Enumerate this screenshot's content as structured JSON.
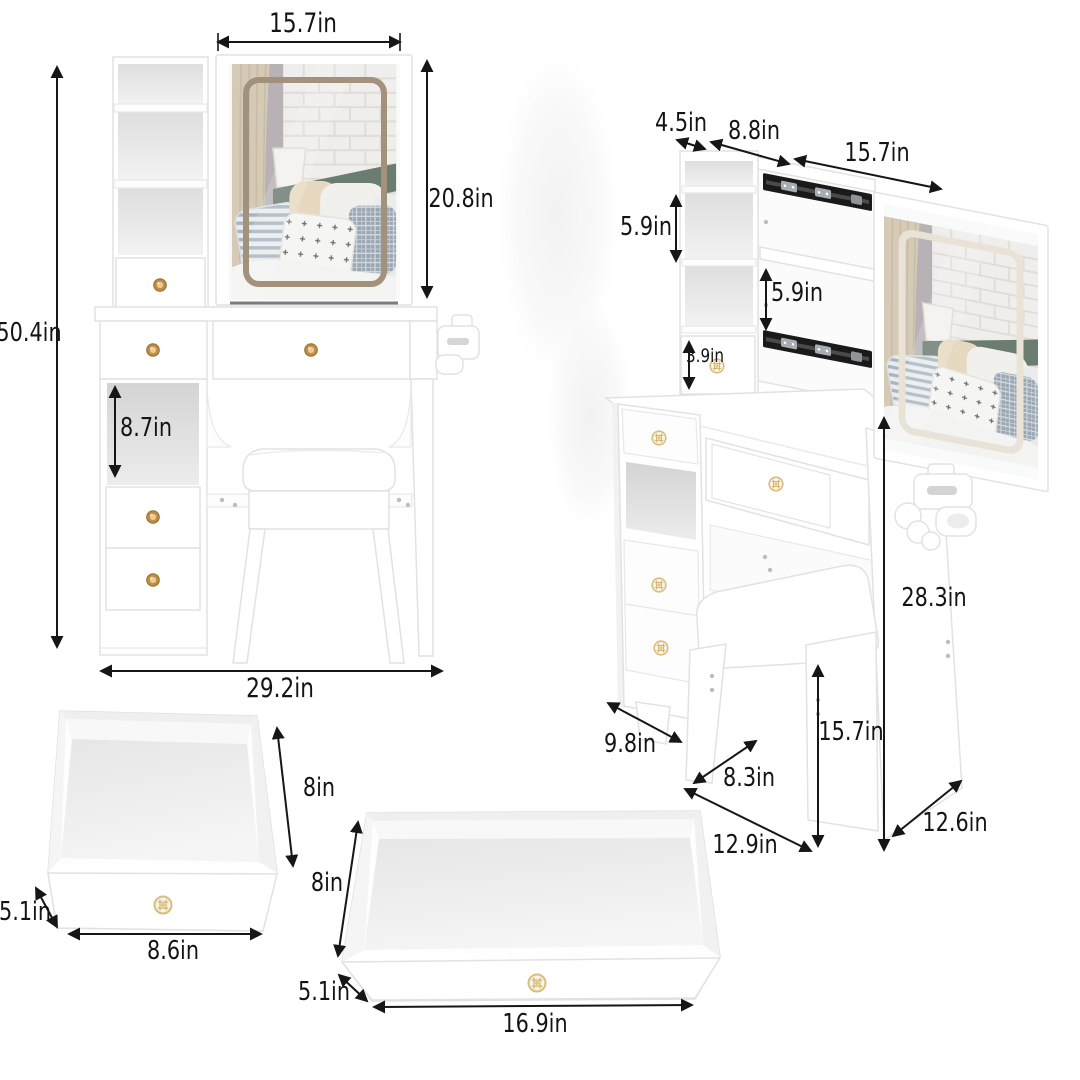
{
  "title": "Vanity table set dimension diagram",
  "colors": {
    "background": "#ffffff",
    "text": "#141414",
    "arrow": "#161616",
    "furniture": "#ffffff",
    "furniture_edge": "#e2e2e2",
    "slide_rail": "#1a1a1a",
    "knob_gold": "#c08f46",
    "knob_crystal_ring": "#d8bd7e",
    "led_frame_front": "#a2927c",
    "led_frame_side": "#e9e3d7",
    "headboard_green": "#5e7064",
    "curtain_beige": "#d7c9b1"
  },
  "views": {
    "front": {
      "name": "assembled front view",
      "dims": {
        "mirror_width": "15.7in",
        "mirror_height": "20.8in",
        "total_height": "50.4in",
        "shelf_space": "8.7in",
        "total_width": "29.2in"
      }
    },
    "side": {
      "name": "angled view with slide-out mirror",
      "dims": {
        "top_depth": "4.5in",
        "back_width": "8.8in",
        "mirror_slide_width": "15.7in",
        "upper_cubby_height": "5.9in",
        "middle_cubby_height": "5.9in",
        "hutch_drawer_height": "3.9in",
        "table_height": "28.3in",
        "stool_height": "15.7in",
        "cabinet_depth": "9.8in",
        "stool_seat_depth": "8.3in",
        "base_depth": "12.9in",
        "tabletop_depth": "12.6in"
      }
    },
    "small_drawer": {
      "name": "small drawer inside view",
      "dims": {
        "depth": "8in",
        "height": "5.1in",
        "width": "8.6in"
      }
    },
    "wide_drawer": {
      "name": "wide drawer inside view",
      "dims": {
        "depth": "8in",
        "height": "5.1in",
        "width": "16.9in"
      }
    }
  }
}
